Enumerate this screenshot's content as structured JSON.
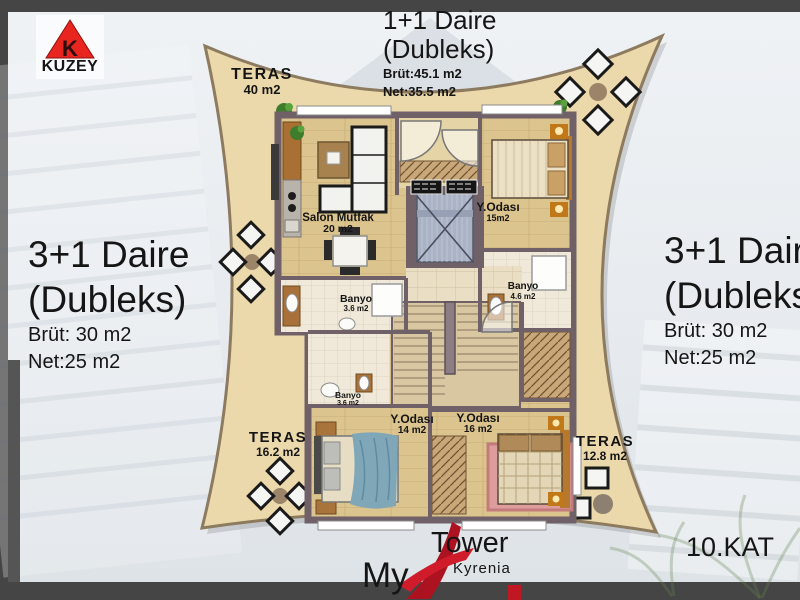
{
  "compass": {
    "letter": "K",
    "label": "KUZEY"
  },
  "units": {
    "top": {
      "title": "1+1 Daire",
      "subtitle": "(Dubleks)",
      "brut": "Brüt:45.1 m2",
      "net": "Net:35.5 m2"
    },
    "left": {
      "title": "3+1 Daire",
      "subtitle": "(Dubleks)",
      "brut": "Brüt: 30 m2",
      "net": "Net:25 m2"
    },
    "right": {
      "title": "3+1 Daire",
      "subtitle": "(Dubleks)",
      "brut": "Brüt: 30 m2",
      "net": "Net:25 m2"
    }
  },
  "terraces": {
    "top": {
      "label": "TERAS",
      "area": "40 m2"
    },
    "bottom_left": {
      "label": "TERAS",
      "area": "16.2 m2"
    },
    "bottom_right": {
      "label": "TERAS",
      "area": "12.8 m2"
    }
  },
  "rooms": {
    "salon": {
      "name": "Salon Mutfak",
      "area": "20 m2"
    },
    "bedroom_top": {
      "name": "Y.Odası",
      "area": "15m2"
    },
    "bath_upper": {
      "name": "Banyo",
      "area": "3.6 m2"
    },
    "bath_right": {
      "name": "Banyo",
      "area": "4.6 m2"
    },
    "bath_lower": {
      "name": "Banyo",
      "area": "3.6 m2"
    },
    "bedroom_left": {
      "name": "Y.Odası",
      "area": "14 m2"
    },
    "bedroom_right": {
      "name": "Y.Odası",
      "area": "16 m2"
    }
  },
  "brand": {
    "my": "My",
    "tower": "Tower",
    "city": "Kyrenia"
  },
  "floor": {
    "label": "10.KAT"
  },
  "colors": {
    "terrace_sand": "#ecd9ab",
    "wall": "#6f6167",
    "wood_floor": "#dcc48f",
    "logo_red": "#b5121f",
    "compass_red": "#e8251f"
  }
}
